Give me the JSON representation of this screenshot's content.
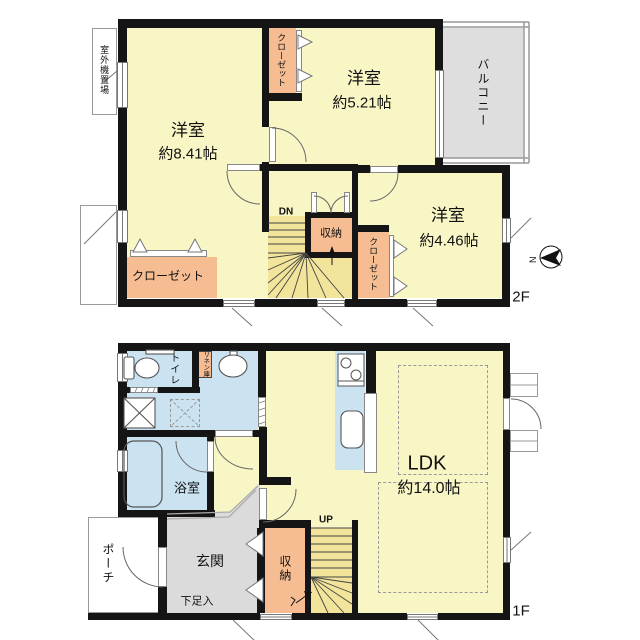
{
  "title": "間取り図",
  "colors": {
    "wall": "#151515",
    "room_yellow": "#f9f6c6",
    "stairs_yellow": "#f2e59b",
    "closet_orange": "#f6bd92",
    "wet_blue": "#cbe3f0",
    "genkan_gray": "#dbdbdb",
    "balcony_gray": "#dedede"
  },
  "floor2": {
    "floor_label": "2F",
    "room_841": {
      "name": "洋室",
      "size": "約8.41帖"
    },
    "room_521": {
      "name": "洋室",
      "size": "約5.21帖"
    },
    "room_446": {
      "name": "洋室",
      "size": "約4.46帖"
    },
    "balcony": "バルコニー",
    "closet_top": "クローゼット",
    "closet_left": "クローゼット",
    "closet_446": "クローゼット",
    "storage": "収納",
    "stairs_down": "DN",
    "outdoor_unit": "室外機置場"
  },
  "floor1": {
    "floor_label": "1F",
    "ldk": {
      "name": "LDK",
      "size": "約14.0帖"
    },
    "toilet": "トイレ",
    "linen": "リネン庫",
    "bath": "浴室",
    "genkan": "玄関",
    "porch": "ポーチ",
    "shoe_box": "下足入",
    "storage": "収納",
    "stairs_up": "UP"
  },
  "compass": {
    "north_label": "N"
  }
}
